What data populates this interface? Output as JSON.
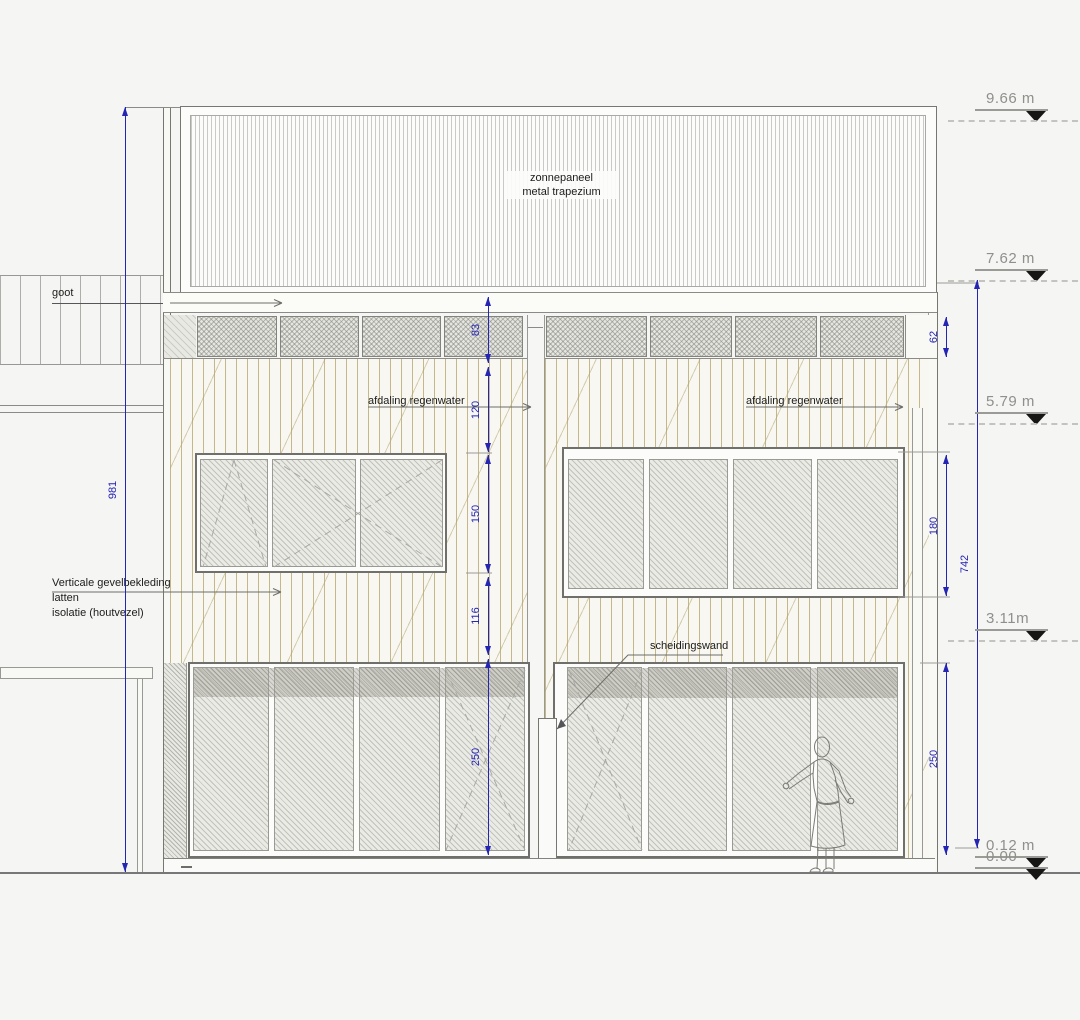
{
  "drawing": {
    "roof_label_line1": "zonnepaneel",
    "roof_label_line2": "metal trapezium",
    "gutter_label": "goot",
    "rain_label_left": "afdaling regenwater",
    "rain_label_right": "afdaling regenwater",
    "partition_label": "scheidingswand",
    "cladding_note_line1": "Verticale gevelbekleding",
    "cladding_note_line2": "latten",
    "cladding_note_line3": "isolatie (houtvezel)"
  },
  "levels": [
    {
      "label": "9.66 m",
      "y": 109
    },
    {
      "label": "7.62 m",
      "y": 269
    },
    {
      "label": "5.79 m",
      "y": 412
    },
    {
      "label": "3.11m",
      "y": 629
    },
    {
      "label": "0.12 m",
      "y": 856
    },
    {
      "label": "0.00",
      "y": 867
    }
  ],
  "dimensions": {
    "left_total": {
      "label": "981",
      "x": 125,
      "y1": 107,
      "y2": 872
    },
    "right_total": {
      "label": "742",
      "x": 977,
      "y1": 280,
      "y2": 848
    },
    "center_chain_x": 488,
    "center_chain": [
      {
        "label": "83",
        "y1": 297,
        "y2": 363
      },
      {
        "label": "120",
        "y1": 367,
        "y2": 452
      },
      {
        "label": "150",
        "y1": 455,
        "y2": 573
      },
      {
        "label": "116",
        "y1": 577,
        "y2": 655
      },
      {
        "label": "250",
        "y1": 659,
        "y2": 855
      }
    ],
    "right_chain_x": 946,
    "right_chain": [
      {
        "label": "62",
        "y1": 317,
        "y2": 357
      },
      {
        "label": "180",
        "y1": 455,
        "y2": 596
      },
      {
        "label": "250",
        "y1": 663,
        "y2": 855
      }
    ]
  },
  "colors": {
    "dimension_blue": "#2525b4",
    "level_text_gray": "#8f8f8c",
    "line_gray": "#8a8a86",
    "cladding_tan": "#b2a268",
    "triangle_black": "#161614"
  }
}
